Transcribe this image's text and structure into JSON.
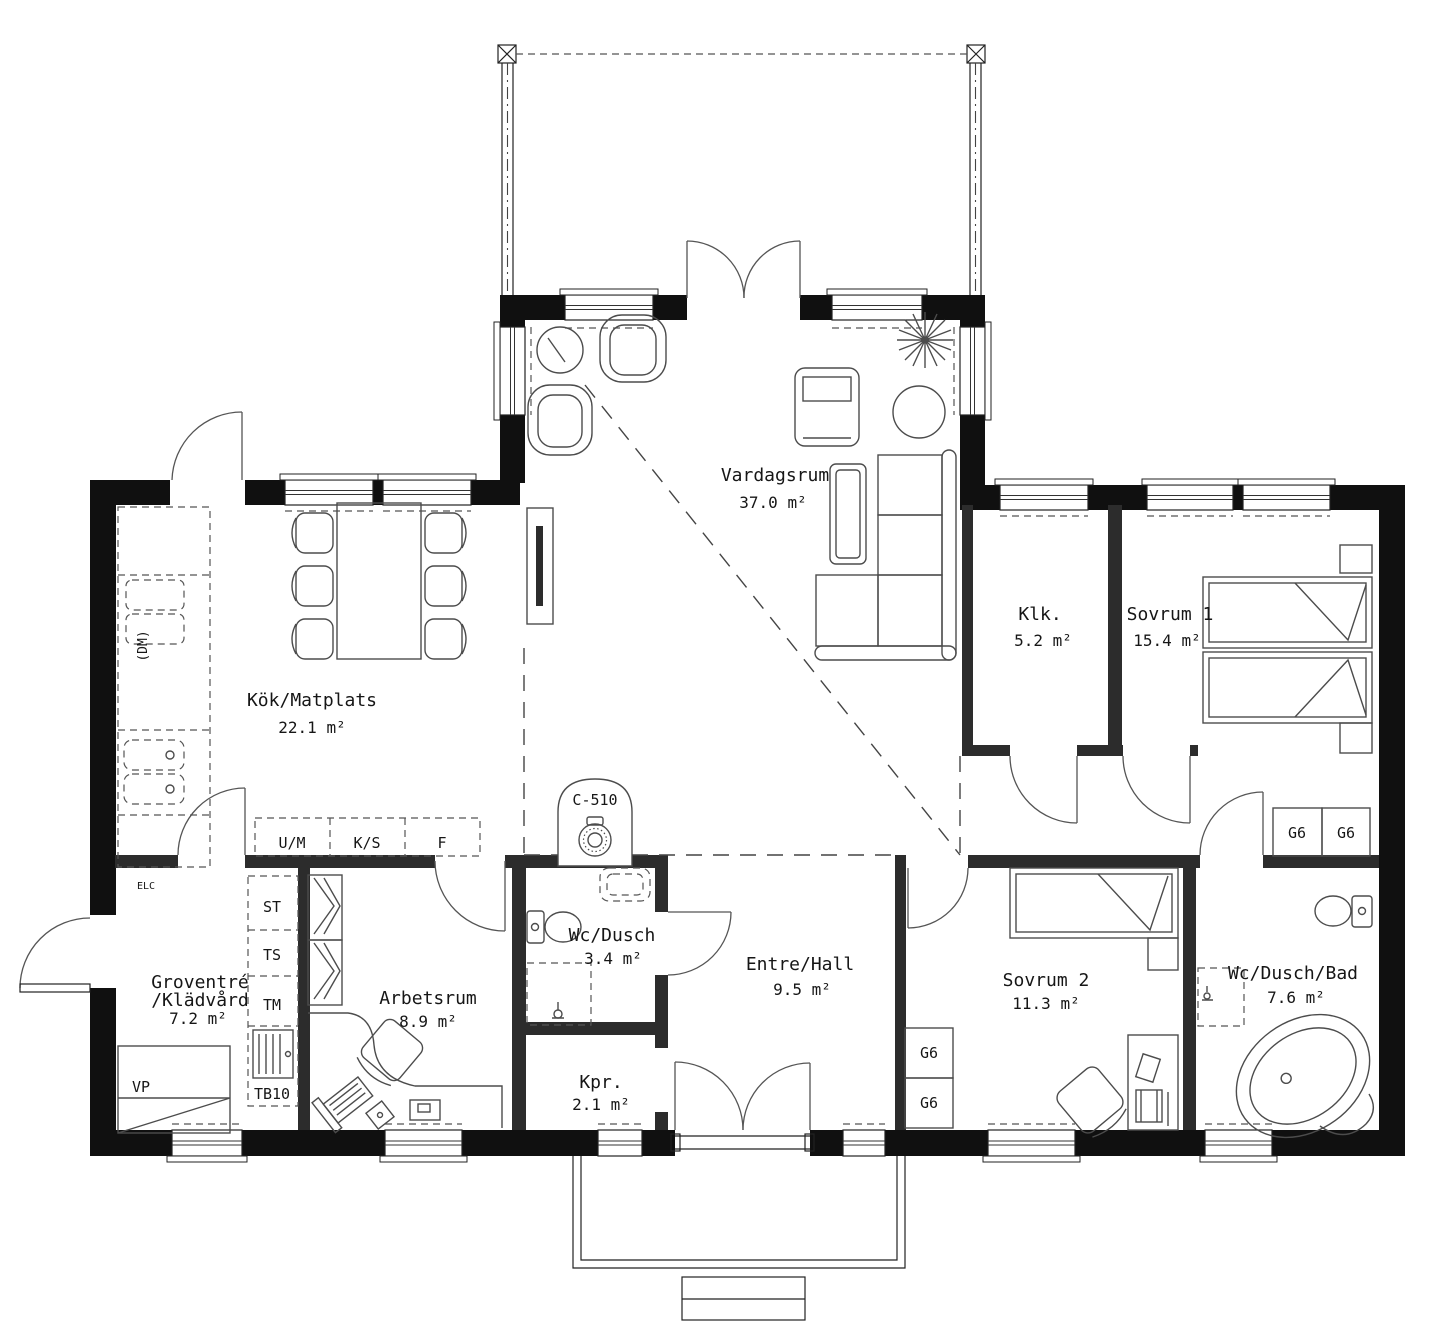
{
  "plan": {
    "rooms": {
      "vardagsrum": {
        "name": "Vardagsrum",
        "area": "37.0 m²"
      },
      "kok": {
        "name": "Kök/Matplats",
        "area": "22.1 m²"
      },
      "klk": {
        "name": "Klk.",
        "area": "5.2 m²"
      },
      "sovrum1": {
        "name": "Sovrum 1",
        "area": "15.4 m²"
      },
      "groventre": {
        "name": "Groventré",
        "name2": "/Klädvård",
        "area": "7.2 m²"
      },
      "arbetsrum": {
        "name": "Arbetsrum",
        "area": "8.9 m²"
      },
      "wc_dusch": {
        "name": "Wc/Dusch",
        "area": "3.4 m²"
      },
      "entre_hall": {
        "name": "Entre/Hall",
        "area": "9.5 m²"
      },
      "kpr": {
        "name": "Kpr.",
        "area": "2.1 m²"
      },
      "sovrum2": {
        "name": "Sovrum 2",
        "area": "11.3 m²"
      },
      "wc_dusch_bad": {
        "name": "Wc/Dusch/Bad",
        "area": "7.6 m²"
      }
    },
    "fixtures": {
      "c510": "C-510",
      "dm": "(DM)",
      "elc": "ELC",
      "vp": "VP",
      "st": "ST",
      "ts": "TS",
      "tm": "TM",
      "tb10": "TB10",
      "um": "U/M",
      "ks": "K/S",
      "f": "F",
      "g6": "G6"
    }
  }
}
